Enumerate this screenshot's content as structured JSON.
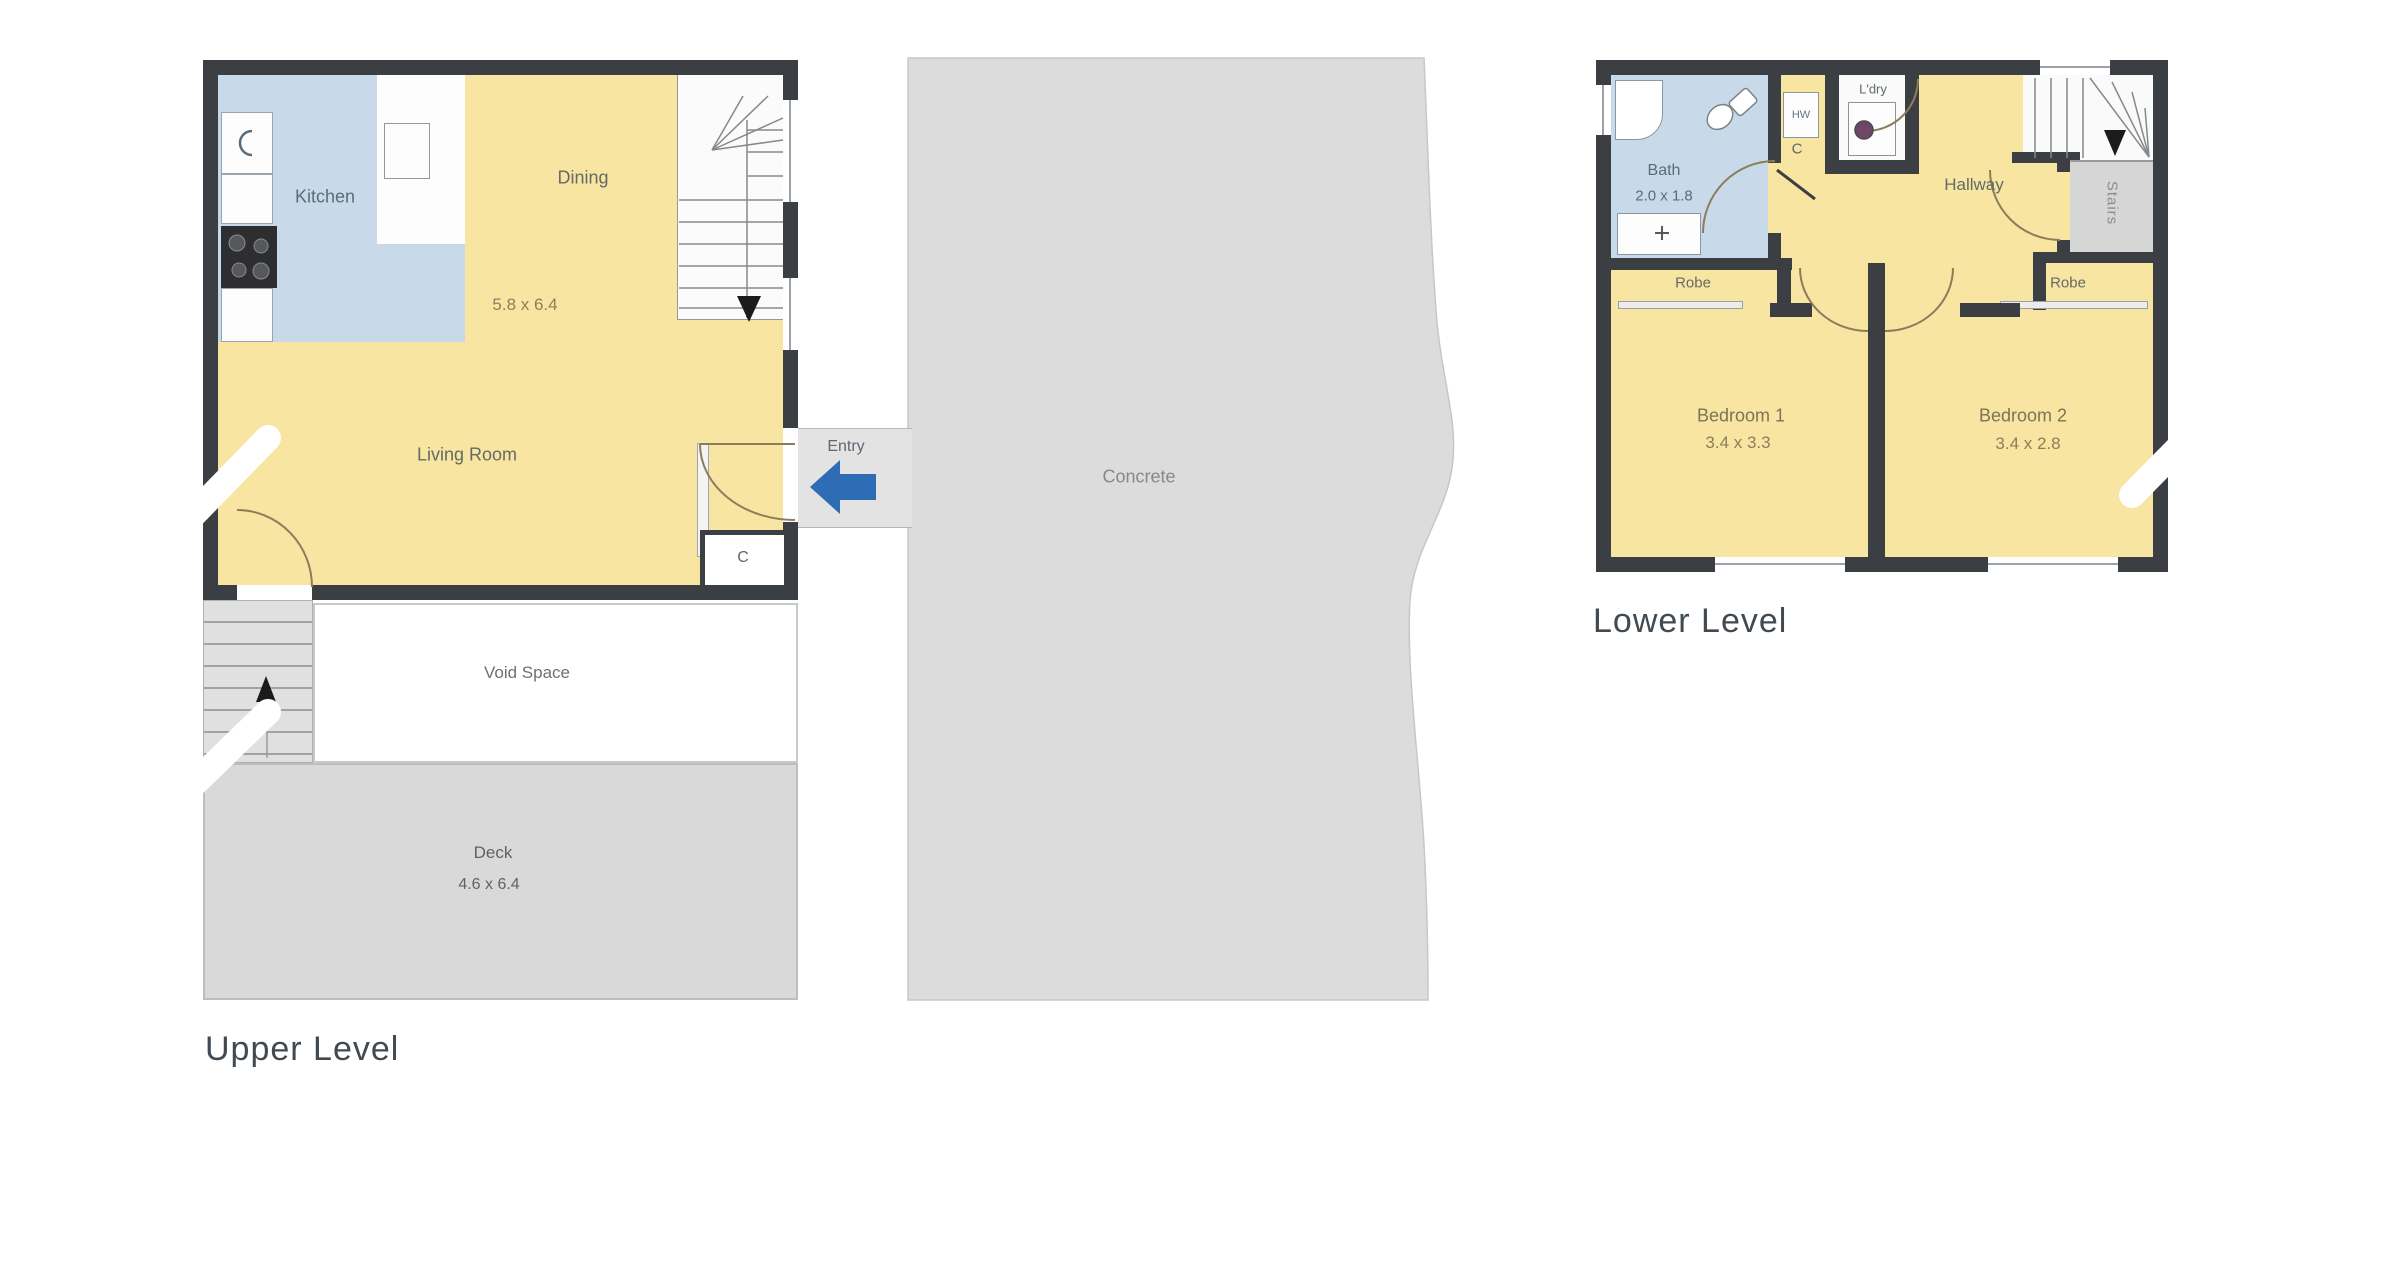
{
  "colors": {
    "wall": "#3b3f43",
    "room_yellow": "#f8e5a1",
    "wet_area_blue": "#c8daea",
    "concrete_gray": "#dcdcdc",
    "deck_gray": "#d9d9d9",
    "entry_arrow_blue": "#2e6cb6"
  },
  "upper": {
    "title": "Upper Level",
    "kitchen": "Kitchen",
    "dining": "Dining",
    "living_room": "Living Room",
    "living_dims": "5.8 x 6.4",
    "entry": "Entry",
    "concrete": "Concrete",
    "void_space": "Void Space",
    "deck": "Deck",
    "deck_dims": "4.6 x 6.4",
    "closet": "C"
  },
  "lower": {
    "title": "Lower Level",
    "bath": "Bath",
    "bath_dims": "2.0 x 1.8",
    "laundry": "L'dry",
    "hot_water": "HW",
    "cupboard": "C",
    "hallway": "Hallway",
    "stairs": "Stairs",
    "robe_left": "Robe",
    "robe_right": "Robe",
    "bedroom1": "Bedroom 1",
    "bedroom1_dims": "3.4 x 3.3",
    "bedroom2": "Bedroom 2",
    "bedroom2_dims": "3.4 x 2.8"
  }
}
